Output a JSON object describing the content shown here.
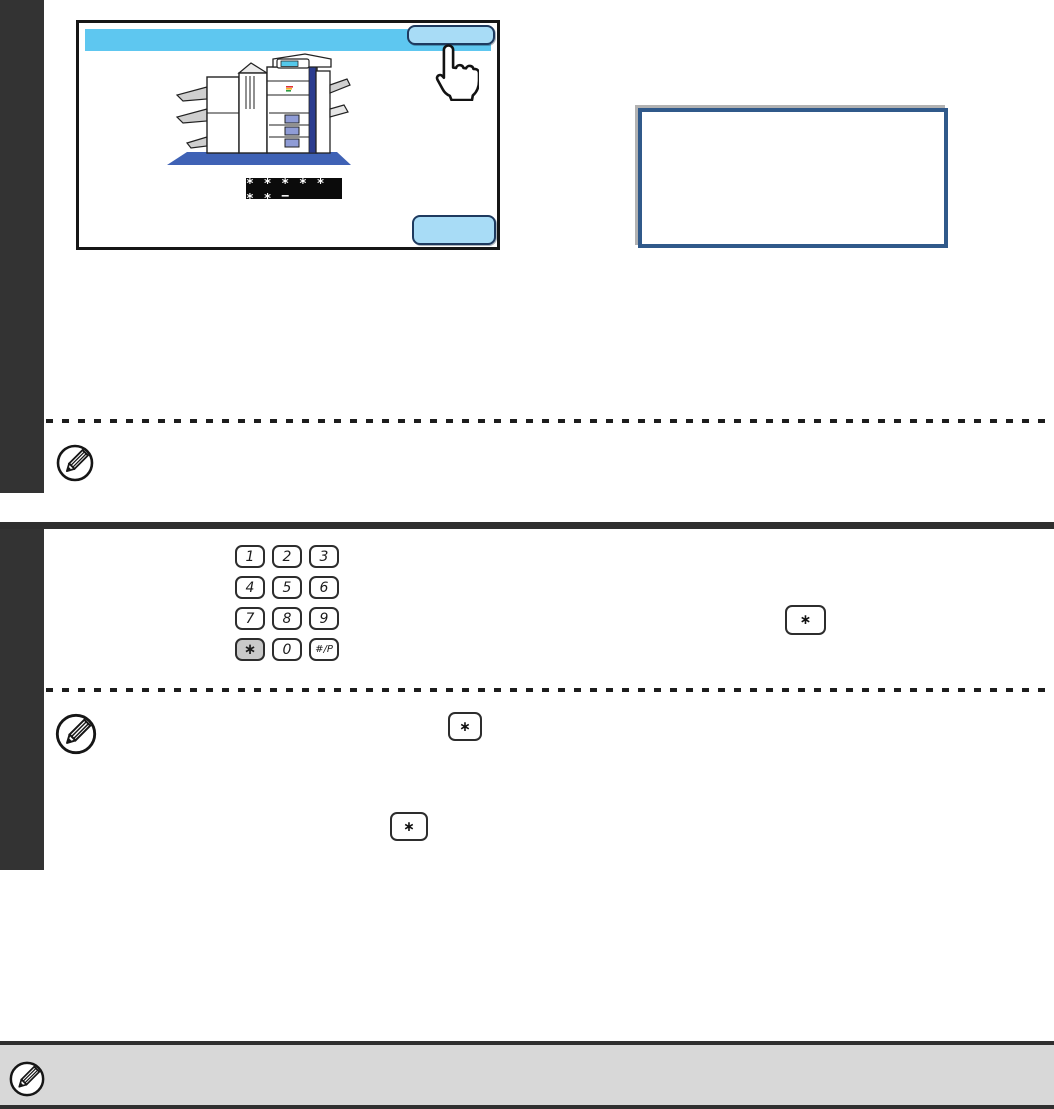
{
  "colors": {
    "sidebar": "#333333",
    "divider": "#2f2f2f",
    "panel_header": "#5ec7f0",
    "button_fill": "#a8dcf6",
    "button_border": "#1e3a5f",
    "callout_border": "#30598a",
    "note_bar_bg": "#d8d8d8",
    "password_bg": "#0b0b0b",
    "key_star_bg": "#c9c9c9",
    "machine_shadow": "#3f62b5",
    "machine_stripe": "#2b3c8f",
    "screen": "#54c8ea"
  },
  "panel": {
    "header_button_label": "",
    "ok_button_label": "",
    "password_display": "∗ ∗ ∗ ∗ ∗ ∗ ∗ −"
  },
  "callout": {
    "text": ""
  },
  "keypad": {
    "keys": [
      {
        "label": "1"
      },
      {
        "label": "2"
      },
      {
        "label": "3"
      },
      {
        "label": "4"
      },
      {
        "label": "5"
      },
      {
        "label": "6"
      },
      {
        "label": "7"
      },
      {
        "label": "8"
      },
      {
        "label": "9"
      },
      {
        "label": "∗"
      },
      {
        "label": "0"
      },
      {
        "label": "#/P"
      }
    ]
  },
  "inline_keys": {
    "star_label": "∗"
  },
  "icons": {
    "note": "pencil-circle-icon",
    "hand": "pointing-hand-cursor",
    "machine": "multifunction-printer-illustration"
  }
}
